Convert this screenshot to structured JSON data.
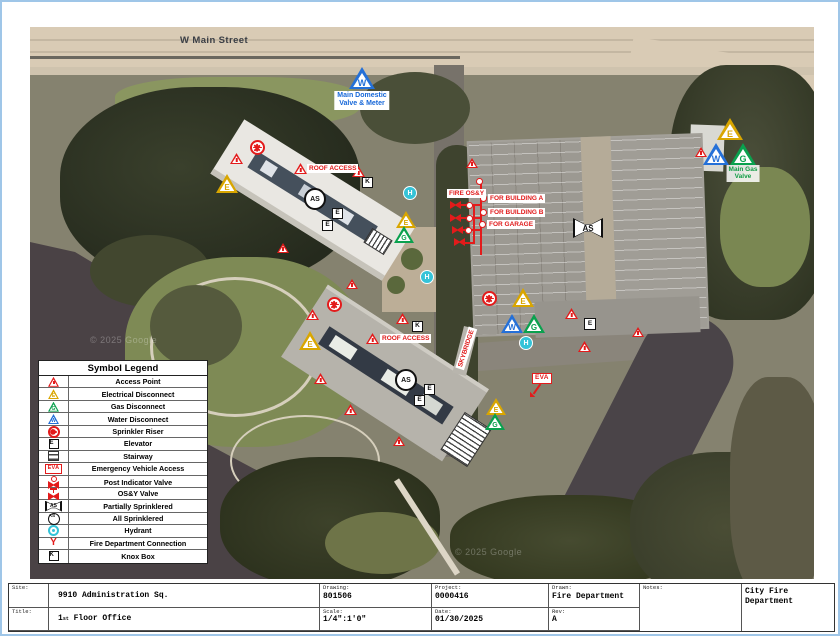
{
  "street_label": "W Main Street",
  "watermark": "© 2025 Google",
  "sym": {
    "E": "E",
    "G": "G",
    "W": "W",
    "K": "K",
    "H": "H",
    "AS": "AS",
    "EVA": "EVA",
    "Y": "Y"
  },
  "map_labels": {
    "main_domestic_line1": "Main Domestic",
    "main_domestic_line2": "Valve & Meter",
    "main_gas_line1": "Main Gas",
    "main_gas_line2": "Valve",
    "fire_osy": "FIRE OS&Y",
    "for_building_a": "FOR BUILDING A",
    "for_building_b": "FOR BUILDING B",
    "for_garage": "FOR GARAGE",
    "roof_access": "ROOF ACCESS",
    "skybridge": "SKYBRIDGE"
  },
  "legend": {
    "title": "Symbol Legend",
    "items": [
      {
        "icon": "access-point-icon",
        "label": "Access Point"
      },
      {
        "icon": "electrical-disconnect-icon",
        "label": "Electrical Disconnect"
      },
      {
        "icon": "gas-disconnect-icon",
        "label": "Gas Disconnect"
      },
      {
        "icon": "water-disconnect-icon",
        "label": "Water Disconnect"
      },
      {
        "icon": "sprinkler-riser-icon",
        "label": "Sprinkler Riser"
      },
      {
        "icon": "elevator-icon",
        "label": "Elevator"
      },
      {
        "icon": "stairway-icon",
        "label": "Stairway"
      },
      {
        "icon": "eva-icon",
        "label": "Emergency Vehicle Access"
      },
      {
        "icon": "post-indicator-valve-icon",
        "label": "Post Indicator Valve"
      },
      {
        "icon": "osy-valve-icon",
        "label": "OS&Y Valve"
      },
      {
        "icon": "partially-sprinklered-icon",
        "label": "Partially Sprinklered"
      },
      {
        "icon": "all-sprinklered-icon",
        "label": "All Sprinklered"
      },
      {
        "icon": "hydrant-icon",
        "label": "Hydrant"
      },
      {
        "icon": "fdc-icon",
        "label": "Fire Department Connection"
      },
      {
        "icon": "knox-box-icon",
        "label": "Knox Box"
      }
    ]
  },
  "titleblock": {
    "site_label": "Site:",
    "site": "9910 Administration Sq.",
    "title_label": "Title:",
    "title_num": "1",
    "title_sup": "st",
    "title_rest": " Floor Office",
    "drawing_label": "Drawing:",
    "drawing": "801506",
    "scale_label": "Scale:",
    "scale": "1/4\":1'0\"",
    "project_label": "Project:",
    "project": "0000416",
    "date_label": "Date:",
    "date": "01/30/2025",
    "drawn_label": "Drawn:",
    "drawn": "Fire Department",
    "rev_label": "Rev:",
    "rev": "A",
    "notes_label": "Notes:",
    "org": "City Fire Department"
  },
  "colors": {
    "access_red": "#e31b1b",
    "electrical_gold": "#d9a600",
    "gas_green": "#0aa14e",
    "water_blue": "#2470d8",
    "hydrant_cyan": "#35c3d8",
    "sheet_border_blue": "#9fc6e8"
  }
}
